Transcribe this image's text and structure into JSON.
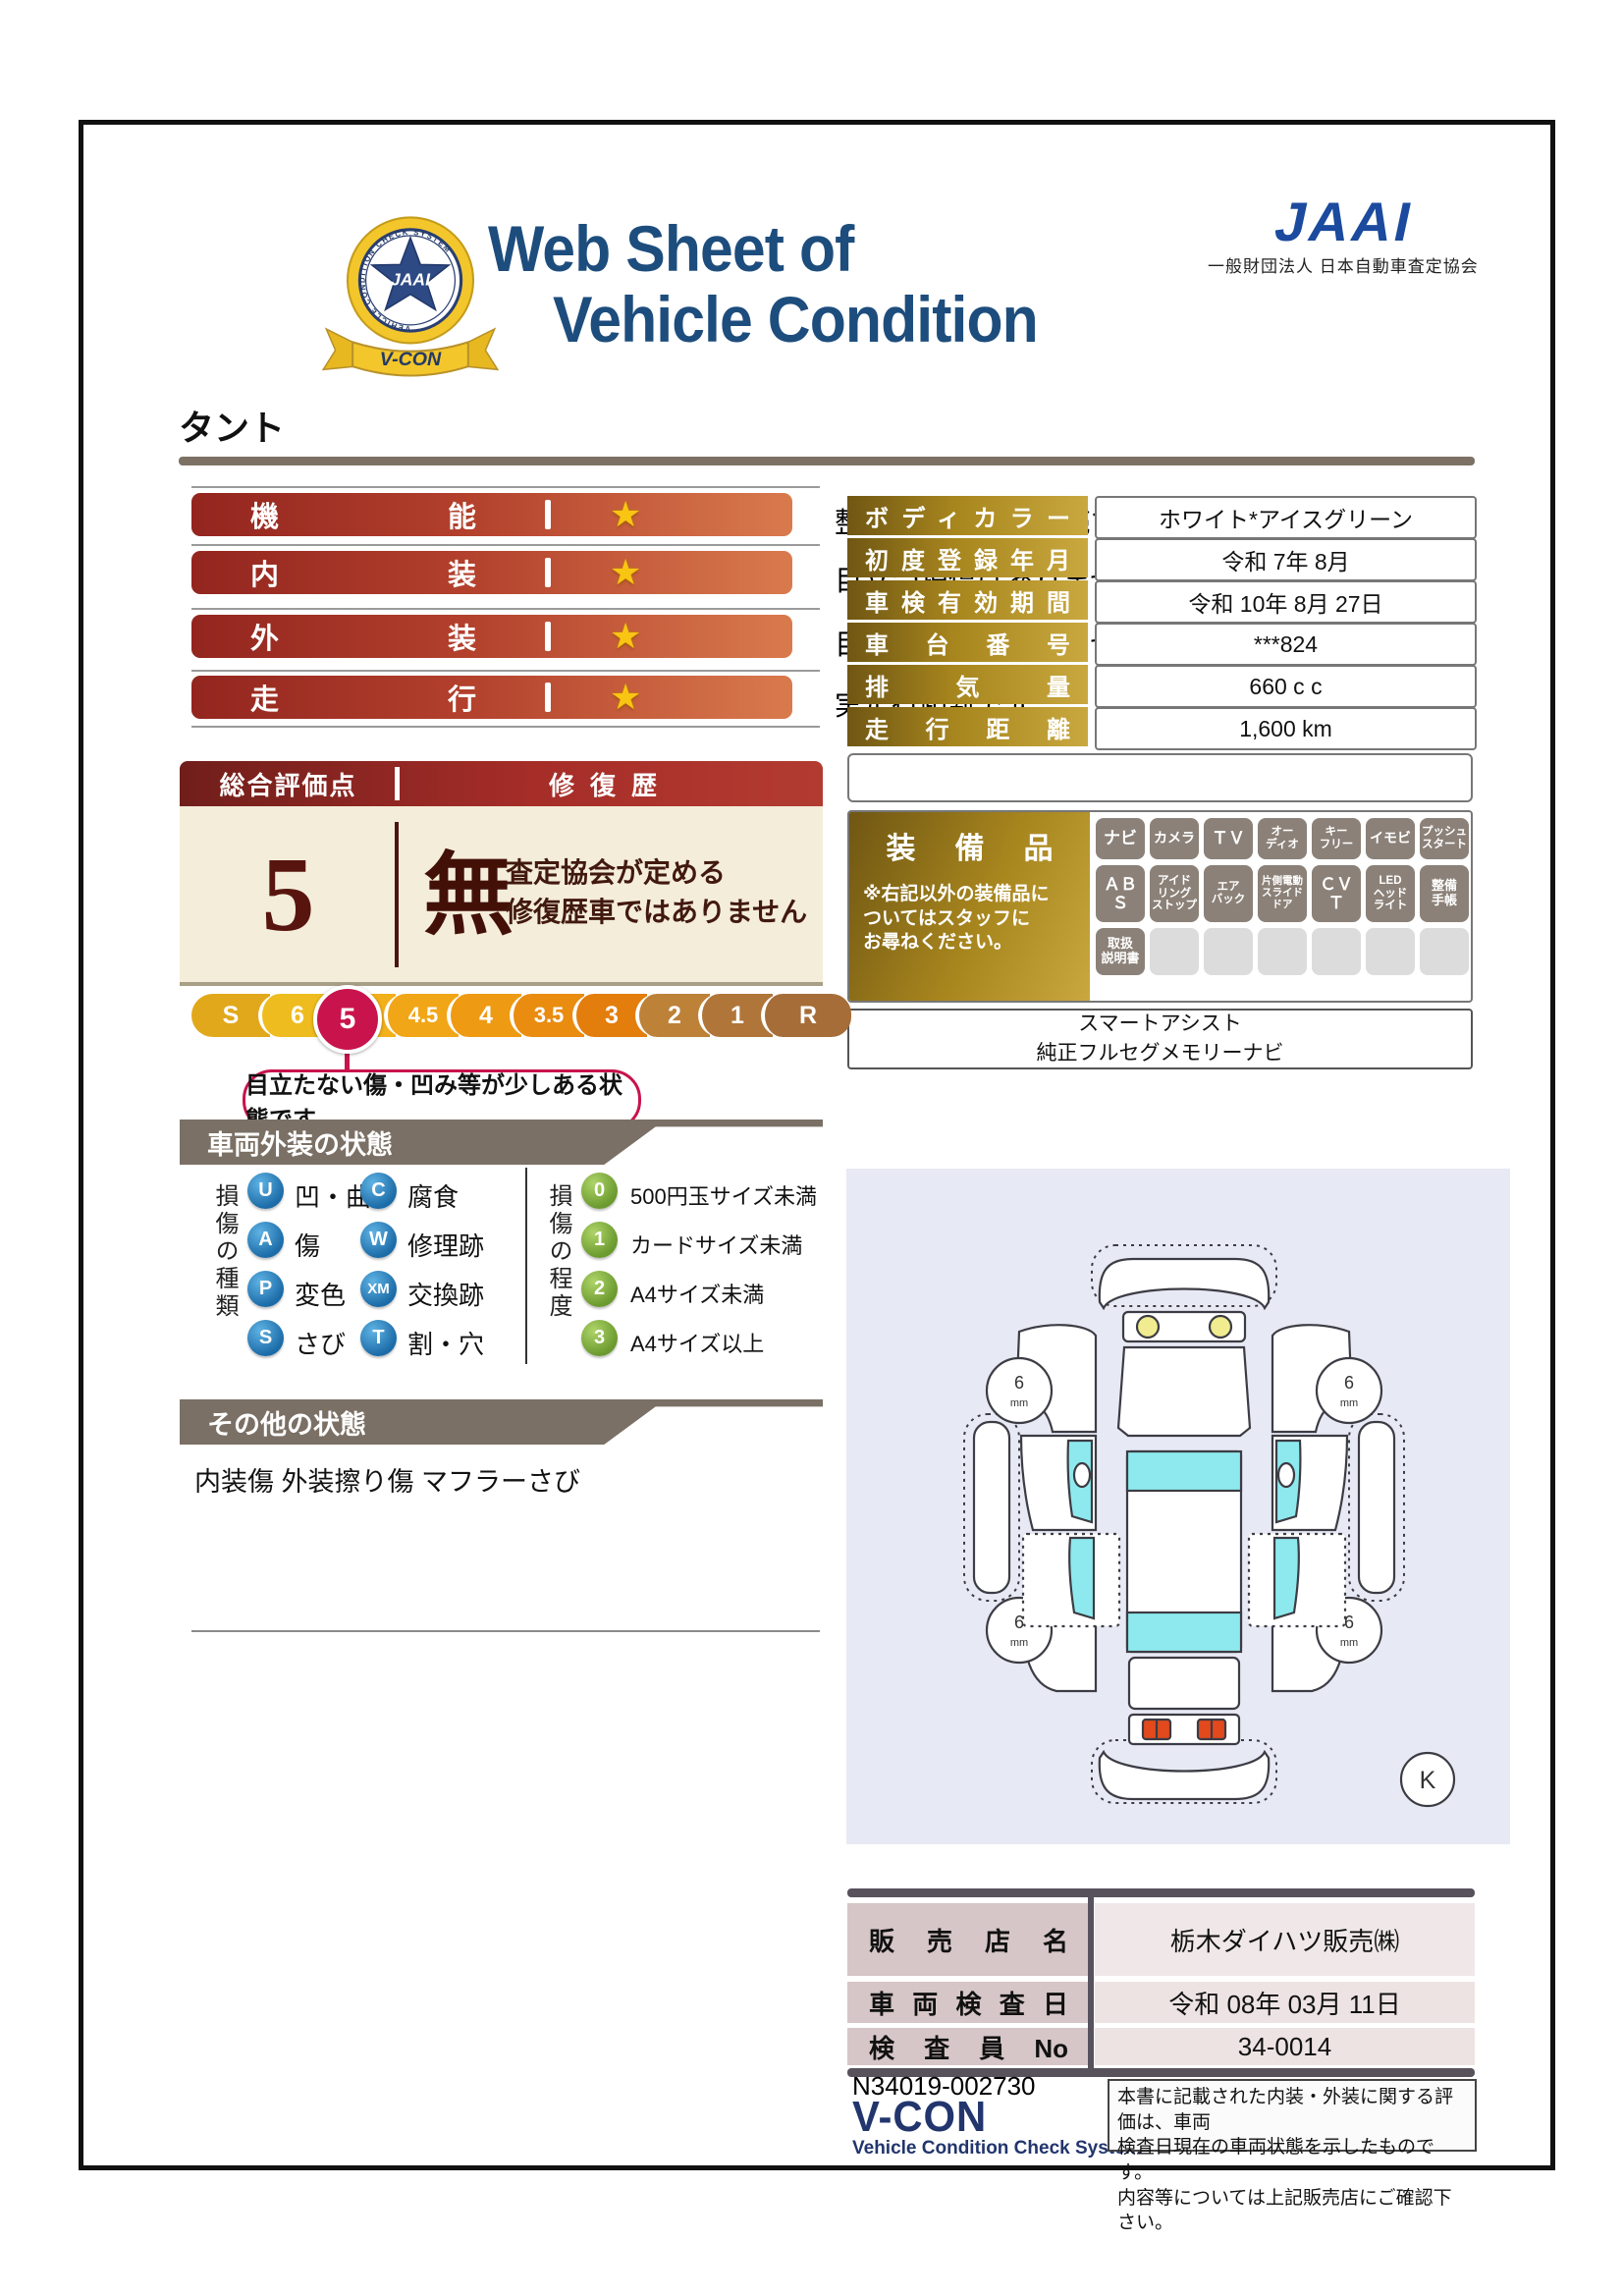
{
  "header": {
    "title_line1": "Web Sheet of",
    "title_line2": "Vehicle Condition",
    "emblem": {
      "center": "JAAI",
      "ring": "VEHICLE CONDITION CHECK SYSTEM",
      "ribbon": "V-CON"
    },
    "jaai": {
      "logo": "JAAI",
      "subtitle": "一般財団法人 日本自動車査定協会"
    }
  },
  "vehicle_name": "タント",
  "star": "★",
  "ratings": [
    {
      "label": "機能",
      "desc": "整備・保証付き販売です"
    },
    {
      "label": "内装",
      "desc": "目立つ損傷はありません"
    },
    {
      "label": "外装",
      "desc": "目立つ損傷はありません"
    },
    {
      "label": "走行",
      "desc": "実走行距離です"
    }
  ],
  "overall": {
    "header_left": "総合評価点",
    "header_right": "修復歴",
    "score": "5",
    "repair_status": "無",
    "repair_desc1": "査定協会が定める",
    "repair_desc2": "修復歴車ではありません",
    "scale": [
      "S",
      "6",
      "5",
      "4.5",
      "4",
      "3.5",
      "3",
      "2",
      "1",
      "R"
    ],
    "selected": "5",
    "bubble": "目立たない傷・凹み等が少しある状態です"
  },
  "exterior": {
    "title": "車両外装の状態",
    "type_header": "損傷の種類",
    "types": [
      {
        "code": "U",
        "label": "凹・曲"
      },
      {
        "code": "A",
        "label": "傷"
      },
      {
        "code": "P",
        "label": "変色"
      },
      {
        "code": "S",
        "label": "さび"
      },
      {
        "code": "C",
        "label": "腐食"
      },
      {
        "code": "W",
        "label": "修理跡"
      },
      {
        "code": "XM",
        "label": "交換跡"
      },
      {
        "code": "T",
        "label": "割・穴"
      }
    ],
    "degree_header": "損傷の程度",
    "degrees": [
      {
        "code": "0",
        "label": "500円玉サイズ未満"
      },
      {
        "code": "1",
        "label": "カードサイズ未満"
      },
      {
        "code": "2",
        "label": "A4サイズ未満"
      },
      {
        "code": "3",
        "label": "A4サイズ以上"
      }
    ]
  },
  "other": {
    "title": "その他の状態",
    "text": "内装傷 外装擦り傷 マフラーさび"
  },
  "details": [
    {
      "label": "ボディカラー",
      "value": "ホワイト*アイスグリーン"
    },
    {
      "label": "初度登録年月",
      "value": "令和 7年 8月"
    },
    {
      "label": "車検有効期間",
      "value": "令和 10年 8月 27日"
    },
    {
      "label": "車台番号",
      "value": "***824"
    },
    {
      "label": "排気量",
      "value": "660 c c"
    },
    {
      "label": "走行距離",
      "value": "1,600 km"
    }
  ],
  "equipment": {
    "title": "装備品",
    "note1": "※右記以外の装備品に",
    "note2": "ついてはスタッフに",
    "note3": "お尋ねください。",
    "badges": [
      "ナビ",
      "カメラ",
      "ＴＶ",
      "オー\nディオ",
      "キー\nフリー",
      "イモビ",
      "プッシュ\nスタート",
      "ＡＢＳ",
      "アイド\nリング\nストップ",
      "エア\nバック",
      "片側電動\nスライド\nドア",
      "ＣＶＴ",
      "LED\nヘッド\nライト",
      "整備\n手帳",
      "取扱\n説明書"
    ],
    "extra1": "スマートアシスト",
    "extra2": "純正フルセグメモリーナビ"
  },
  "diagram": {
    "wheel_value": "6",
    "wheel_unit": "mm",
    "marker": "K"
  },
  "dealer": [
    {
      "label": "販売店名",
      "value": "栃木ダイハツ販売㈱"
    },
    {
      "label": "車両検査日",
      "value": "令和 08年 03月 11日"
    },
    {
      "label": "検査員No",
      "value": "34-0014"
    }
  ],
  "footer": {
    "doc_no": "N34019-002730",
    "vcon": "V-CON",
    "vcon_sub": "Vehicle Condition Check System",
    "disclaimer1": "本書に記載された内装・外装に関する評価は、車両",
    "disclaimer2": "検査日現在の車両状態を示したものです。",
    "disclaimer3": "内容等については上記販売店にご確認下さい。"
  }
}
